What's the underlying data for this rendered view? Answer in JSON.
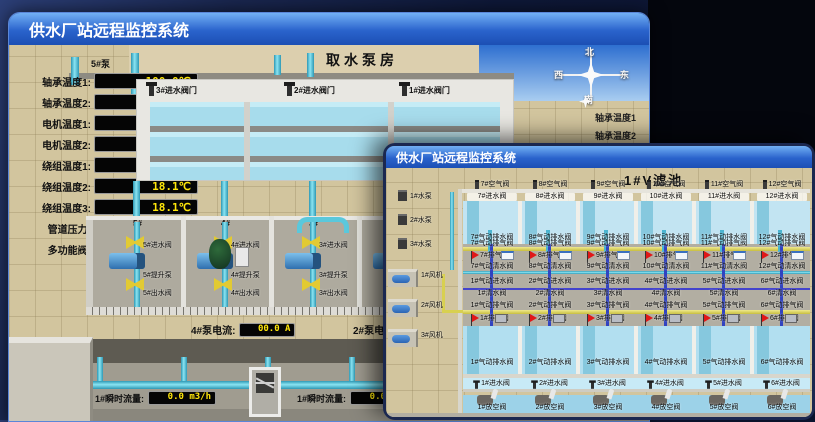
{
  "back_window": {
    "title": "供水厂站远程监控系统",
    "scene_title": "取水泵房",
    "pump_panel": {
      "header": "5#泵",
      "rows": [
        {
          "label": "轴承温度1:",
          "value": "100.0℃"
        },
        {
          "label": "轴承温度2:",
          "value": "100.0℃"
        },
        {
          "label": "电机温度1:",
          "value": "18.1℃"
        },
        {
          "label": "电机温度2:",
          "value": "17.9℃"
        },
        {
          "label": "绕组温度1:",
          "value": "18.0℃"
        },
        {
          "label": "绕组温度2:",
          "value": "18.1℃"
        },
        {
          "label": "绕组温度3:",
          "value": "18.1℃"
        },
        {
          "label": "管道压力:",
          "value": "0.0007MPa"
        },
        {
          "label": "多功能阀:",
          "value": "0%"
        }
      ]
    },
    "inlet_valve_labels": [
      "3#进水阀门",
      "2#进水阀门",
      "1#进水阀门"
    ],
    "compass": {
      "n": "北",
      "s": "南",
      "w": "西",
      "e": "东"
    },
    "side_labels": [
      "轴承温度1",
      "轴承温度2"
    ],
    "bays": [
      {
        "num": "5#",
        "inlet": "5#进水阀",
        "pump": "5#提升泵",
        "outlet": "5#出水阀"
      },
      {
        "num": "4#",
        "inlet": "4#进水阀",
        "pump": "4#提升泵",
        "outlet": "4#出水阀"
      },
      {
        "num": "3#",
        "inlet": "3#进水阀",
        "pump": "3#提升泵",
        "outlet": "3#出水阀"
      },
      {
        "num": "2#",
        "inlet": "2#进水阀",
        "pump": "2#提升泵",
        "outlet": "2#出水阀"
      },
      {
        "num": "1#",
        "inlet": "1#进水阀",
        "pump": "1#提升泵",
        "outlet": "1#出水阀"
      }
    ],
    "current_readouts": [
      {
        "label": "4#泵电流:",
        "value": "00.0 A"
      },
      {
        "label": "2#泵电流:",
        "value": ""
      }
    ],
    "flow_readouts": [
      {
        "label": "1#瞬时流量:",
        "value": "0.0 m3/h"
      },
      {
        "label": "1#瞬时流量:",
        "value": "0.0 m3/h"
      }
    ]
  },
  "front_window": {
    "title": "供水厂站远程监控系统",
    "scene_title": "1#V滤池",
    "pumps": [
      {
        "label": "1#水泵"
      },
      {
        "label": "2#水泵"
      },
      {
        "label": "3#水泵"
      }
    ],
    "fans": [
      {
        "label": "1#风机"
      },
      {
        "label": "2#风机"
      },
      {
        "label": "3#风机"
      }
    ],
    "top_cells": [
      {
        "air": "7#空气阀",
        "inlet": "7#进水阀",
        "pneu_drain": "7#气动排水阀",
        "pneu_vent": "7#气动排气阀",
        "vent": "7#排气阀",
        "pneu_clean": "7#气动清水阀"
      },
      {
        "air": "8#空气阀",
        "inlet": "8#进水阀",
        "pneu_drain": "8#气动排水阀",
        "pneu_vent": "8#气动排气阀",
        "vent": "8#排气阀",
        "pneu_clean": "8#气动清水阀"
      },
      {
        "air": "9#空气阀",
        "inlet": "9#进水阀",
        "pneu_drain": "9#气动排水阀",
        "pneu_vent": "9#气动排气阀",
        "vent": "9#排气阀",
        "pneu_clean": "9#气动清水阀"
      },
      {
        "air": "10#空气阀",
        "inlet": "10#进水阀",
        "pneu_drain": "10#气动排水阀",
        "pneu_vent": "10#气动排气阀",
        "vent": "10#排气阀",
        "pneu_clean": "10#气动清水阀"
      },
      {
        "air": "11#空气阀",
        "inlet": "11#进水阀",
        "pneu_drain": "11#气动排水阀",
        "pneu_vent": "11#气动排气阀",
        "vent": "11#排气阀",
        "pneu_clean": "11#气动清水阀"
      },
      {
        "air": "12#空气阀",
        "inlet": "12#进水阀",
        "pneu_drain": "12#气动排水阀",
        "pneu_vent": "12#气动排气阀",
        "vent": "12#排气阀",
        "pneu_clean": "12#气动清水阀"
      }
    ],
    "bottom_cells": [
      {
        "pneu_inlet": "1#气动进水阀",
        "clean": "1#清水阀",
        "pneu_vent": "1#气动排气阀",
        "vent": "1#排气阀",
        "pneu_drain": "1#气动排水阀",
        "inlet": "1#进水阀",
        "empty": "1#放空阀"
      },
      {
        "pneu_inlet": "2#气动进水阀",
        "clean": "2#清水阀",
        "pneu_vent": "2#气动排气阀",
        "vent": "2#排气阀",
        "pneu_drain": "2#气动排水阀",
        "inlet": "2#进水阀",
        "empty": "2#放空阀"
      },
      {
        "pneu_inlet": "3#气动进水阀",
        "clean": "3#清水阀",
        "pneu_vent": "3#气动排气阀",
        "vent": "3#排气阀",
        "pneu_drain": "3#气动排水阀",
        "inlet": "3#进水阀",
        "empty": "3#放空阀"
      },
      {
        "pneu_inlet": "4#气动进水阀",
        "clean": "4#清水阀",
        "pneu_vent": "4#气动排气阀",
        "vent": "4#排气阀",
        "pneu_drain": "4#气动排水阀",
        "inlet": "4#进水阀",
        "empty": "4#放空阀"
      },
      {
        "pneu_inlet": "5#气动进水阀",
        "clean": "5#清水阀",
        "pneu_vent": "5#气动排气阀",
        "vent": "5#排气阀",
        "pneu_drain": "5#气动排水阀",
        "inlet": "5#进水阀",
        "empty": "5#放空阀"
      },
      {
        "pneu_inlet": "6#气动进水阀",
        "clean": "6#清水阀",
        "pneu_vent": "6#气动排气阀",
        "vent": "6#排气阀",
        "pneu_drain": "6#气动排水阀",
        "inlet": "6#进水阀",
        "empty": "6#放空阀"
      }
    ]
  },
  "colors": {
    "titlebar_blue": "#2a63cc",
    "led_text": "#ffe60a",
    "pipe_cyan": "#5ac8dc",
    "valve_yellow": "#e2ca32",
    "flag_red": "#e01818",
    "water": "#a7dcec",
    "ground_tan": "#d2c59e"
  }
}
